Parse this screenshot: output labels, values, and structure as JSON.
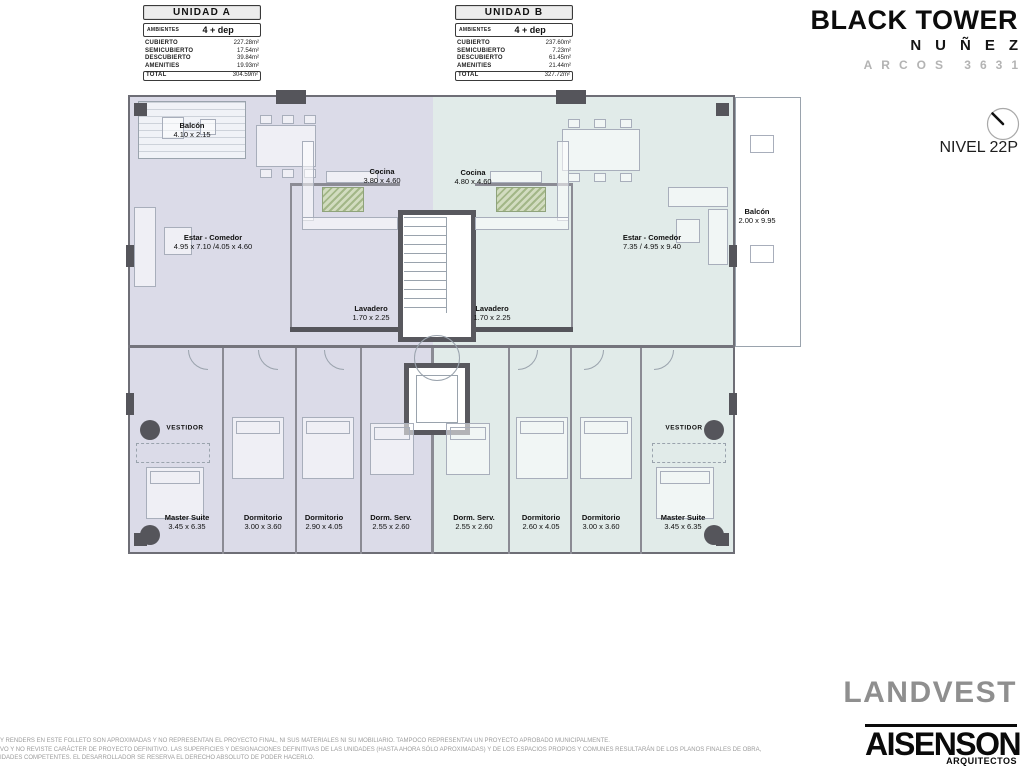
{
  "units_legend": {
    "unit_a": {
      "title": "UNIDAD A",
      "ambientes_label": "AMBIENTES",
      "ambientes_value": "4 + dep",
      "rows": [
        {
          "label": "CUBIERTO",
          "value": "227.28m²"
        },
        {
          "label": "SEMICUBIERTO",
          "value": "17.54m²"
        },
        {
          "label": "DESCUBIERTO",
          "value": "39.84m²"
        },
        {
          "label": "AMENITIES",
          "value": "19.93m²"
        }
      ],
      "total_label": "TOTAL",
      "total_value": "304.59m²"
    },
    "unit_b": {
      "title": "UNIDAD B",
      "ambientes_label": "AMBIENTES",
      "ambientes_value": "4 + dep",
      "rows": [
        {
          "label": "CUBIERTO",
          "value": "237.60m²"
        },
        {
          "label": "SEMICUBIERTO",
          "value": "7.23m²"
        },
        {
          "label": "DESCUBIERTO",
          "value": "61.45m²"
        },
        {
          "label": "AMENITIES",
          "value": "21.44m²"
        }
      ],
      "total_label": "TOTAL",
      "total_value": "327.72m²"
    }
  },
  "brand": {
    "title": "BLACK TOWER",
    "subtitle": "NUÑEZ",
    "address": "ARCOS 3631"
  },
  "level": {
    "label": "NIVEL 22P",
    "compass_icon": "north-needle"
  },
  "plan": {
    "colors": {
      "unit_a_fill": "#dbdbe8",
      "unit_b_fill": "#e1ebe9",
      "wall_dark": "#55555b",
      "wall_medium": "#8b8b94",
      "plant_green": "#a3b788"
    },
    "rooms": [
      {
        "name": "Balcón",
        "dims": "4.10 x 2.15"
      },
      {
        "name": "Estar - Comedor",
        "dims": "4.95 x 7.10 /4.05 x 4.60"
      },
      {
        "name": "Cocina",
        "dims": "3.80 x 4.60"
      },
      {
        "name": "Lavadero",
        "dims": "1.70 x 2.25"
      },
      {
        "name": "VESTIDOR",
        "dims": ""
      },
      {
        "name": "Master Suite",
        "dims": "3.45 x 6.35"
      },
      {
        "name": "Dormitorio",
        "dims": "3.00 x 3.60"
      },
      {
        "name": "Dormitorio",
        "dims": "2.90 x 4.05"
      },
      {
        "name": "Dorm. Serv.",
        "dims": "2.55 x 2.60"
      },
      {
        "name": "Cocina",
        "dims": "4.80 x 4.60"
      },
      {
        "name": "Estar - Comedor",
        "dims": "7.35 / 4.95 x 9.40"
      },
      {
        "name": "Balcón",
        "dims": "2.00 x 9.95"
      },
      {
        "name": "Lavadero",
        "dims": "1.70 x 2.25"
      },
      {
        "name": "Dorm. Serv.",
        "dims": "2.55 x 2.60"
      },
      {
        "name": "Dormitorio",
        "dims": "2.60 x 4.05"
      },
      {
        "name": "Dormitorio",
        "dims": "3.00 x 3.60"
      },
      {
        "name": "Master Suite",
        "dims": "3.45 x 6.35"
      },
      {
        "name": "VESTIDOR",
        "dims": ""
      }
    ]
  },
  "footer": {
    "disclaimer_lines": [
      "Y RENDERS EN ESTE FOLLETO SON APROXIMADAS Y NO REPRESENTAN EL PROYECTO FINAL, NI SUS MATERIALES NI SU MOBILIARIO. TAMPOCO REPRESENTAN UN PROYECTO APROBADO MUNICIPALMENTE.",
      "VO Y NO REVISTE CARÁCTER DE PROYECTO DEFINITIVO. LAS SUPERFICIES Y DESIGNACIONES DEFINITIVAS DE LAS UNIDADES (HASTA AHORA SÓLO APROXIMADAS) Y DE LOS ESPACIOS PROPIOS Y COMUNES RESULTARÁN DE LOS PLANOS FINALES DE OBRA,",
      "IDADES COMPETENTES. EL DESARROLLADOR SE RESERVA EL DERECHO ABSOLUTO DE PODER HACERLO."
    ],
    "landvest_logo": "LANDVEST",
    "aisenson_logo": "AISENSON",
    "aisenson_sub": "ARQUITECTOS"
  }
}
